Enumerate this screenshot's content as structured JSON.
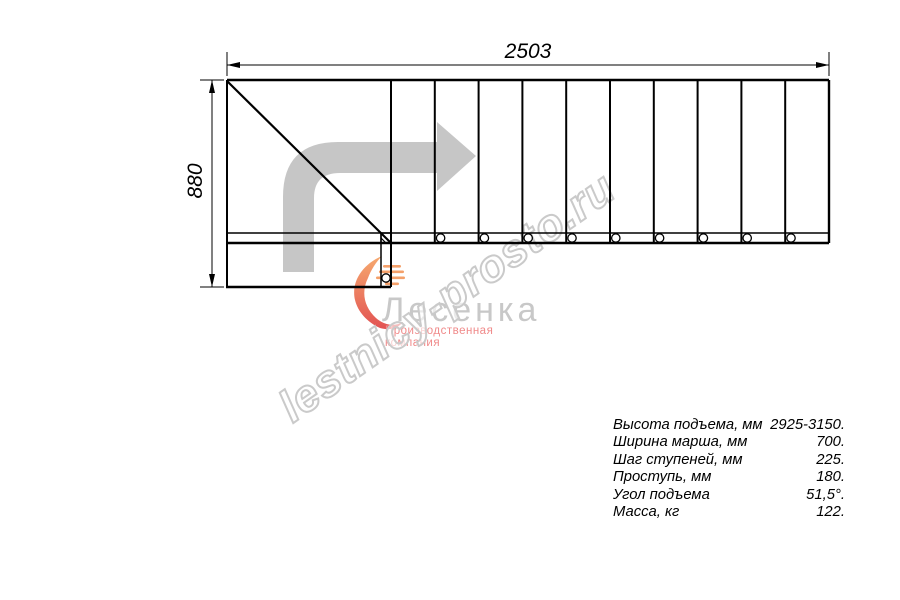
{
  "dimensions": {
    "width_label": "2503",
    "height_label": "880"
  },
  "watermark": {
    "text": "lestnicy-prosto.ru"
  },
  "logo": {
    "name": "Лесенка",
    "tagline": "Производственная компания"
  },
  "specs": {
    "rows": [
      {
        "label": "Высота подъема, мм",
        "value": "2925-3150."
      },
      {
        "label": "Ширина марша, мм",
        "value": "700."
      },
      {
        "label": "Шаг ступеней, мм",
        "value": "225."
      },
      {
        "label": "Проступь, мм",
        "value": "180."
      },
      {
        "label": "Угол подъема",
        "value": "51,5°."
      },
      {
        "label": "Масса, кг",
        "value": "122."
      }
    ]
  },
  "drawing": {
    "steps": 10,
    "balusters": 9,
    "colors": {
      "line": "#000000",
      "arrow": "#c6c6c6",
      "logo_gray": "#c8c8c8",
      "logo_red": "#f08a8a",
      "watermark_stroke": "#cacaca"
    }
  }
}
